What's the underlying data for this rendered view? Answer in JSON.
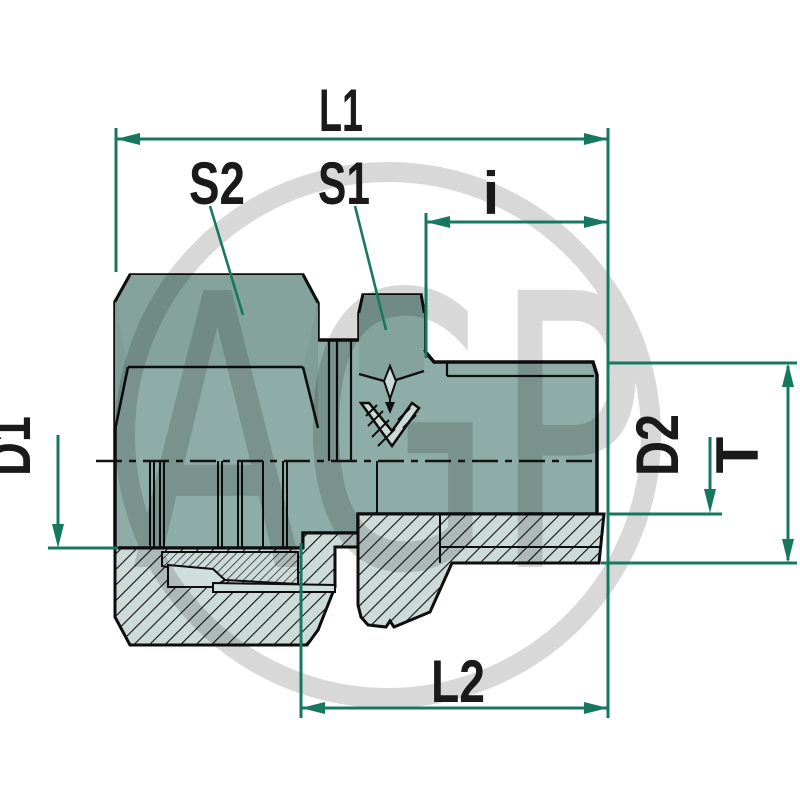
{
  "watermark": {
    "text": "AGP"
  },
  "dimensions": {
    "l1": {
      "label": "L1"
    },
    "s2": {
      "label": "S2"
    },
    "s1": {
      "label": "S1"
    },
    "i": {
      "label": "i"
    },
    "d1": {
      "label": "D1"
    },
    "d2": {
      "label": "D2"
    },
    "t": {
      "label": "T"
    },
    "l2": {
      "label": "L2"
    }
  },
  "colors": {
    "dimension_accent": "#16795f",
    "label_text": "#1a1a1a",
    "outline": "#0d0d0d",
    "body": "#8fada8",
    "body_shaded": "#85a39d",
    "body_dark": "#7e9d97",
    "section_fill": "#ccdbd7",
    "section_light": "#cfdeda",
    "watermark_gray": "#d9d9d9",
    "background": "#ffffff"
  }
}
